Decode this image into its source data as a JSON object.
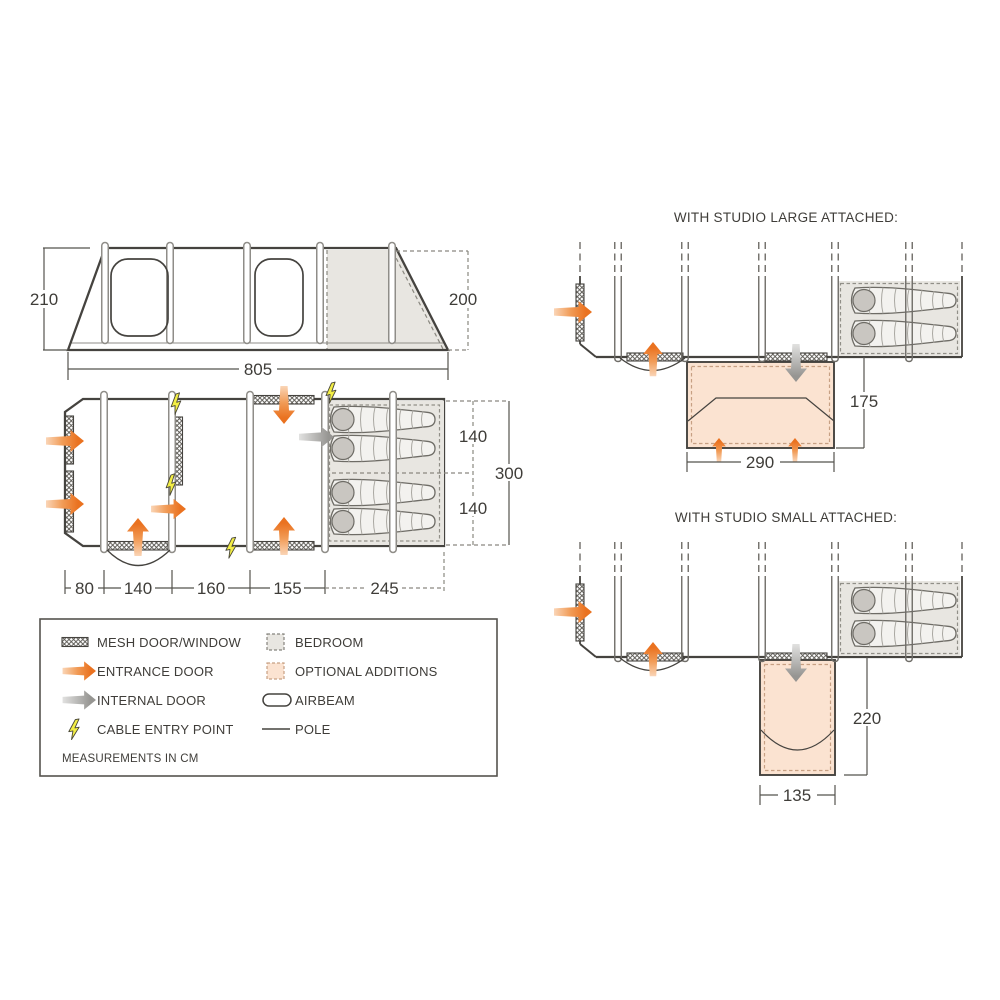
{
  "side_view": {
    "height_left": "210",
    "height_right": "200",
    "length": "805"
  },
  "floorplan": {
    "section_widths": [
      "80",
      "140",
      "160",
      "155",
      "245"
    ],
    "bedroom_depth_top": "140",
    "bedroom_depth_bottom": "140",
    "total_width": "300"
  },
  "studio_large": {
    "title": "WITH STUDIO LARGE ATTACHED:",
    "width": "290",
    "depth": "175"
  },
  "studio_small": {
    "title": "WITH STUDIO SMALL ATTACHED:",
    "width": "135",
    "depth": "220"
  },
  "legend": {
    "items": [
      {
        "label": "MESH DOOR/WINDOW"
      },
      {
        "label": "ENTRANCE DOOR"
      },
      {
        "label": "INTERNAL DOOR"
      },
      {
        "label": "CABLE ENTRY POINT"
      },
      {
        "label": "BEDROOM"
      },
      {
        "label": "OPTIONAL ADDITIONS"
      },
      {
        "label": "AIRBEAM"
      },
      {
        "label": "POLE"
      }
    ],
    "note": "MEASUREMENTS IN CM"
  },
  "colors": {
    "entrance_orange": "#ea7220",
    "internal_gray": "#969592",
    "bedroom_fill": "#e8e6e1",
    "optional_fill": "#fbe3d1",
    "cable_yellow": "#f3ee45",
    "line_dark": "#45433f"
  }
}
